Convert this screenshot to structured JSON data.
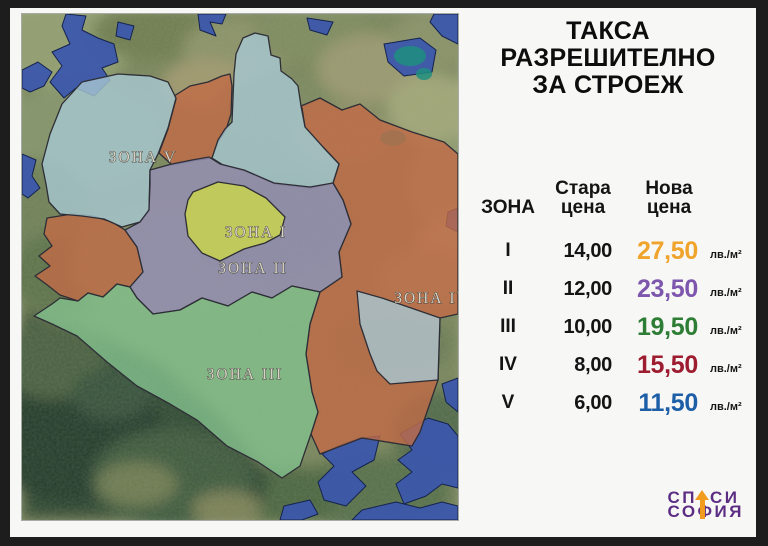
{
  "panel": {
    "title": "ТАКСА РАЗРЕШИТЕЛНО\nЗА СТРОЕЖ",
    "table": {
      "headers": {
        "zone": "ЗОНА",
        "old_price": "Стара цена",
        "new_price": "Нова цена"
      },
      "unit": "лв./м²",
      "rows": [
        {
          "zone": "I",
          "old": "14,00",
          "new": "27,50",
          "new_color": "#f0a42c"
        },
        {
          "zone": "II",
          "old": "12,00",
          "new": "23,50",
          "new_color": "#7d56ad"
        },
        {
          "zone": "III",
          "old": "10,00",
          "new": "19,50",
          "new_color": "#2e7d35"
        },
        {
          "zone": "IV",
          "old": "8,00",
          "new": "15,50",
          "new_color": "#9d1c2f"
        },
        {
          "zone": "V",
          "old": "6,00",
          "new": "11,50",
          "new_color": "#1d5fa7"
        }
      ]
    },
    "logo": {
      "line1_left": "СП",
      "line1_right": "СИ",
      "line2": "СОФИЯ",
      "text_color": "#5c2e83",
      "arrow_color": "#f29c1f"
    }
  },
  "map": {
    "labels": [
      {
        "text": "ЗОНА V"
      },
      {
        "text": "ЗОНА I"
      },
      {
        "text": "ЗОНА II"
      },
      {
        "text": "ЗОНА III"
      },
      {
        "text": "ЗОНА IV"
      }
    ],
    "zone_colors": {
      "zone1": "#c9d44e",
      "zone2": "#9690b8",
      "zone3": "#83c18d",
      "zone4": "#c06b47",
      "zone5": "#a7c8d2",
      "out_of_zone": "#3b57ab"
    }
  }
}
